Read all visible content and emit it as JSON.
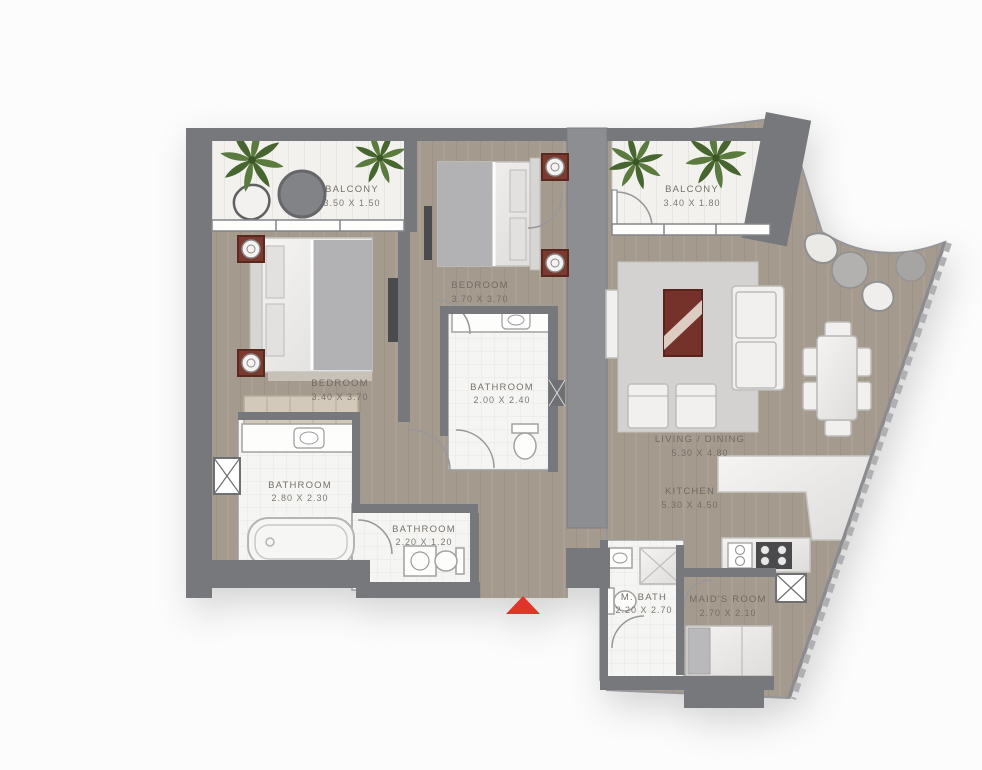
{
  "plan": {
    "title": "apartment-floor-plan",
    "colors": {
      "wall": "#77787c",
      "wall_light": "#8d8e91",
      "floor_wood": "#a59a8e",
      "balcony_deck": "#f2f1ee",
      "bathroom_tile": "#f5f5f3",
      "rug": "#d3d2d0",
      "nightstand_wood": "#7b3a30",
      "coffee_table_wood": "#74322a",
      "entrance_arrow": "#e0352b",
      "label_text": "#6e675f",
      "plant_green": "#5a7a3e"
    },
    "rooms": {
      "balcony_left": {
        "label": "BALCONY",
        "dims": "3.50 X 1.50"
      },
      "bedroom_left": {
        "label": "BEDROOM",
        "dims": "3.40 X 3.70"
      },
      "bedroom_mid": {
        "label": "BEDROOM",
        "dims": "3.70 X 3.70"
      },
      "bathroom_mid": {
        "label": "BATHROOM",
        "dims": "2.00 X 2.40"
      },
      "bathroom_left": {
        "label": "BATHROOM",
        "dims": "2.80 X 2.30"
      },
      "bathroom_small": {
        "label": "BATHROOM",
        "dims": "2.20 X 1.20"
      },
      "balcony_right": {
        "label": "BALCONY",
        "dims": "3.40 X 1.80"
      },
      "living_dining": {
        "label": "LIVING / DINING",
        "dims": "5.30 X 4.80"
      },
      "kitchen": {
        "label": "KITCHEN",
        "dims": "5.30 X 4.50"
      },
      "maid_bath": {
        "label": "M. BATH",
        "dims": "2.20 X 2.70"
      },
      "maids_room": {
        "label": "MAID'S ROOM",
        "dims": "2.70 X 2.10"
      }
    }
  }
}
